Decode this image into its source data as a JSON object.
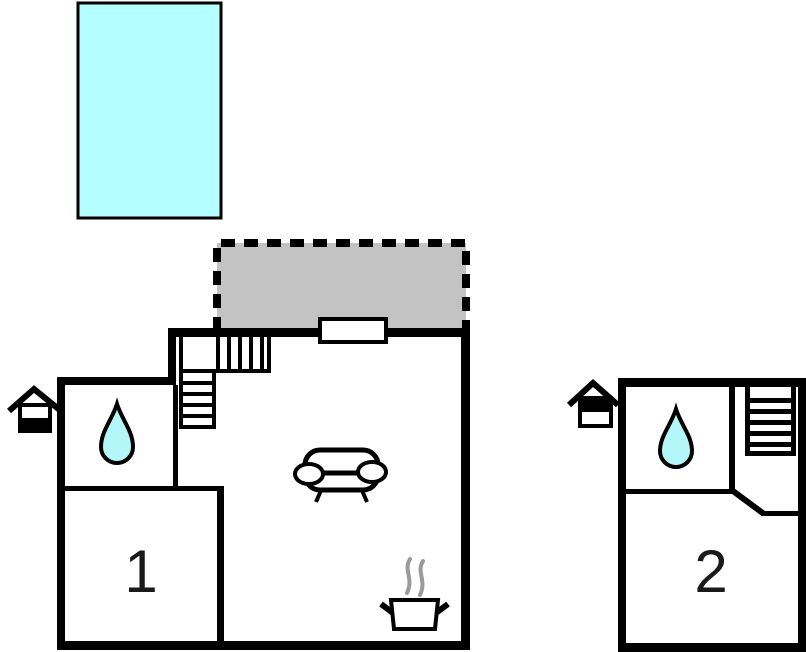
{
  "plan": {
    "units": [
      {
        "label": "1"
      },
      {
        "label": "2"
      }
    ],
    "colors": {
      "pool_water": "#b4feff",
      "terrace": "#c3c3c3",
      "water_drop": "#b4f7f9",
      "steam": "#9a9a9a",
      "wall": "#000000"
    },
    "icons": {
      "pool": "swimming-pool",
      "terrace": "terrace-dashed-area",
      "entrance": "house-entrance-icon",
      "bathroom": "water-drop-icon",
      "living_room": "sofa-icon",
      "kitchen": "cooking-pot-icon",
      "stairs": "stairs-icon",
      "window": "window"
    }
  }
}
